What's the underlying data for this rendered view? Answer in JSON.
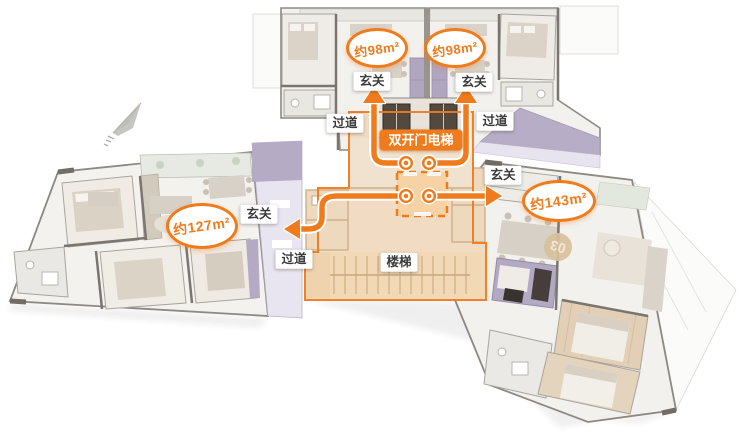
{
  "colors": {
    "accent_orange": "#F07B1C",
    "core_peach": "#F2D9BC",
    "lavender": "#B6ABC4",
    "watermark_tan": "#D8C19C",
    "label_text": "#3B3B3B"
  },
  "labels": {
    "entry": "玄关",
    "corridor": "过道",
    "stairs": "楼梯",
    "elevator": "双开门电梯"
  },
  "units": {
    "north_left": {
      "area": "约98m²"
    },
    "north_right": {
      "area": "约98m²"
    },
    "west": {
      "area": "约127m²"
    },
    "east": {
      "area": "约143m²"
    }
  },
  "watermark": {
    "unit_number": "03"
  },
  "icons": {
    "compass": "north-arrow"
  }
}
